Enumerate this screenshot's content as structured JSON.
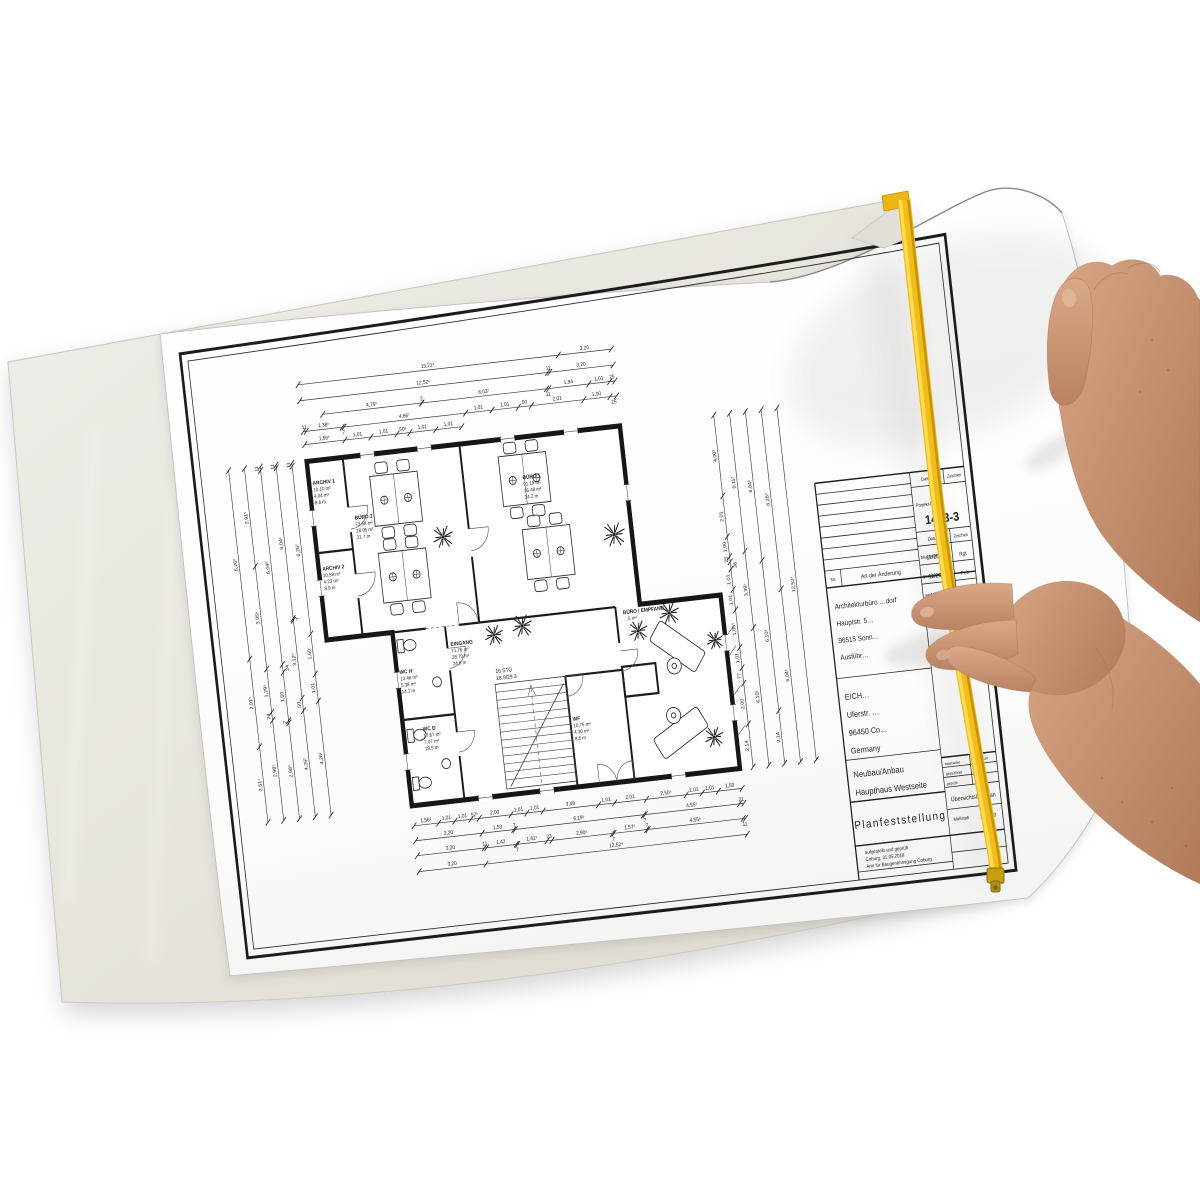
{
  "colors": {
    "background": "#ffffff",
    "sleeve": "#e9e6df",
    "sleeve_edge": "#d8d4cb",
    "paper": "#fdfdfc",
    "ink": "#1d1d1d",
    "zip_yellow": "#f0bd1a",
    "zip_highlight": "#ffda55",
    "zip_shadow": "#c3930c",
    "skin": "#c79478",
    "skin_shadow": "#a5765a"
  },
  "title_block": {
    "revision": {
      "nr": "Nr.",
      "header": "Art der Änderung",
      "datum": "Datum",
      "zeichen": "Zeichen"
    },
    "project_no_label": "Projekt-Nr.:",
    "project_no": "1443-3",
    "staff_table": {
      "datum": "Datum",
      "zeichen": "Zeichen",
      "rows": [
        {
          "label": "bearbeitet",
          "datum": "11/2017",
          "zeichen": "Rgt"
        },
        {
          "label": "gezeichnet",
          "datum": "11/2017",
          "zeichen": "Poh"
        },
        {
          "label": "geprüft",
          "datum": "12/2017",
          "zeichen": "Rev"
        }
      ]
    },
    "architect": [
      "Architekturbüro …dorf",
      "Hauptstr. 5…",
      "96515 Sonn…",
      "Ausführ…"
    ],
    "client": [
      "EICH…",
      "Uferstr. …",
      "96450 Co…",
      "Germany"
    ],
    "project": [
      "Neubau/Anbau",
      "Haupthaus Westseite"
    ],
    "main_title": "Planfeststellung",
    "mini_table": {
      "rows": [
        "bearbeitet",
        "gezeichnet",
        "geprüft"
      ],
      "datum": "Datum"
    },
    "doc_type": "Übersichtslageplan",
    "scale_label": "Maßstab",
    "scale": "1:1.000",
    "approval": [
      "aufgestellt und geprüft",
      "Coburg, 31.05.2018",
      "Amt für Baugenehmigung Coburg"
    ]
  },
  "plan": {
    "stairs": {
      "line1": "16 STG",
      "line2": "18.9/29.3"
    },
    "rooms": {
      "archiv1": {
        "name": "ARCHIV 1",
        "lines": [
          "10.10 m²",
          "4.04 m²",
          "8.6 m"
        ]
      },
      "archiv2": {
        "name": "ARCHIV 2",
        "lines": [
          "10.58 m²",
          "4.23 m²",
          "8.9 m"
        ]
      },
      "buero2": {
        "name": "BÜRO 2",
        "lines": [
          "72.58 m²",
          "28.95 m²",
          "21.7 m"
        ]
      },
      "buero1": {
        "name": "BÜRO 1",
        "lines": [
          "91.19 m²",
          "36.48 m²",
          "24.2 m"
        ]
      },
      "eingang": {
        "name": "EINGANG",
        "lines": [
          "71.76 m²",
          "28.70 m²",
          "24.8 m"
        ]
      },
      "wc_h": {
        "name": "WC H",
        "lines": [
          "13.46 m²",
          "5.38 m²",
          "14.1 m"
        ]
      },
      "wc_d": {
        "name": "WC D",
        "lines": [
          "17.67 m²",
          "7.07 m²",
          "18.5 m"
        ]
      },
      "wf": {
        "name": "WF",
        "lines": [
          "10.75 m²",
          "4.30 m²",
          "8.6 m"
        ]
      },
      "empfang": {
        "name": "BÜRO / EMPFANG",
        "lines": [
          "…5 m²"
        ]
      }
    },
    "dimension_chains": {
      "t1": [
        "1,56⁵",
        "1,01",
        "1,01",
        "50⁵",
        "1,01",
        "1,01"
      ],
      "t2": [
        "11",
        "1,38⁵",
        "7",
        "4,66⁷",
        "1,01",
        "1,01",
        "50",
        "2,01",
        "1,00",
        "25"
      ],
      "t3": [
        "4,79⁵",
        "2",
        "6,03⁷",
        "11",
        "1,94",
        "1,01",
        "25"
      ],
      "t4": [
        "12,52⁵",
        "11",
        "3,20"
      ],
      "t5": [
        "15,72⁴",
        "3,20"
      ],
      "b1": [
        "1,56⁵",
        "1,01",
        "1,01",
        "52⁵",
        "2,00",
        "1,01",
        "1,01",
        "3,49",
        "1,01",
        "2,01",
        "2,50⁵",
        "1,01",
        "1,01",
        "1,50"
      ],
      "b2": [
        "3,20",
        "1,53",
        "7",
        "6,19⁵",
        "7",
        "4,55⁵",
        "21"
      ],
      "b3": [
        "3,20",
        "11",
        "1,42",
        "7",
        "1,41⁵",
        "23",
        "2,90⁵",
        "7",
        "1,57⁵",
        "7",
        "4,55⁵",
        "11"
      ],
      "b4": [
        "3,20",
        "12,52⁴"
      ],
      "l1": [
        "6,26²",
        "2,91⁵",
        "2,51⁴"
      ],
      "l2": [
        "2,91⁵",
        "3,05⁶",
        "1,29⁵",
        "24",
        "2,98⁶"
      ],
      "l3": [
        "11",
        "6,04²",
        "24",
        "1,50",
        "7",
        "2,98⁶"
      ],
      "l4": [
        "11",
        "6,04²",
        "7",
        "3,12⁵",
        "50",
        "4,26²"
      ],
      "l5": [
        "11",
        "6,26²",
        "1,50",
        "1,01",
        "4,26²"
      ],
      "r1": [
        "4,00³",
        "2,01",
        "1,00",
        "25",
        "36",
        "1,01",
        "1,01",
        "1,86⁵",
        "1,01",
        "77",
        "2,00",
        "2,14"
      ],
      "r2": [
        "6,11²",
        "3,39⁵",
        "6,10³"
      ],
      "r3": [
        "6,04²",
        "6,10³",
        "2,14"
      ],
      "r4": [
        "6,26²",
        "6,04²"
      ],
      "r5": [
        "12,52⁴"
      ]
    }
  }
}
